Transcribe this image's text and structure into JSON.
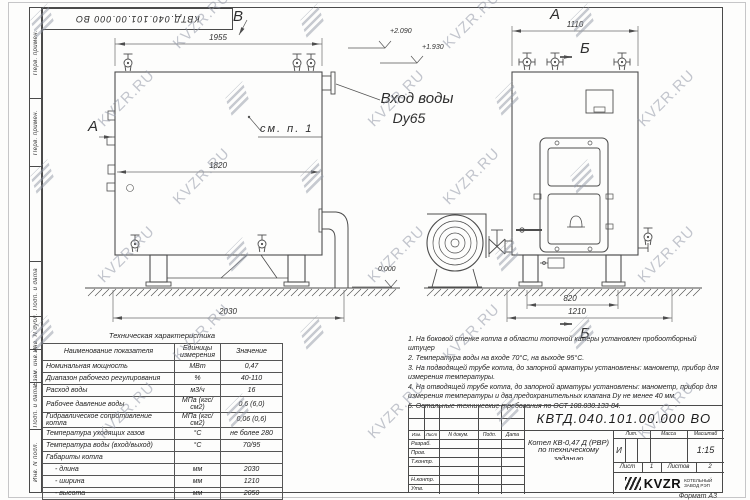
{
  "sheet": {
    "watermark_text": "KVZR.RU",
    "stamp_doc_number": "КВТД.040.101.00.000 ВО",
    "margin_labels": [
      "Перв. примен.",
      "Перв. примен.",
      "Подп. и дата",
      "Инв. N дубл.",
      "Взам. инв. N",
      "Подп. и дата",
      "Инв. N подл."
    ],
    "format_label": "Формат А3"
  },
  "left_view": {
    "dim_top": "1955",
    "dim_inner": "1820",
    "dim_bottom": "2030",
    "label_a": "А",
    "label_b": "В",
    "see_note": "см. п. 1",
    "elev_top": "+2.090",
    "elev_mid": "+1.930",
    "elev_zero": "0.000",
    "inlet_title": "Вход воды",
    "inlet_size": "Dy65"
  },
  "right_view": {
    "dim_top": "1110",
    "dim_base": "820",
    "dim_outer": "1210",
    "label_a": "А",
    "label_b_top": "Б",
    "label_b_bottom": "Б"
  },
  "spec_table": {
    "title": "Техническая характеристика",
    "headers": [
      "Наименование показателя",
      "Единицы измерения",
      "Значение"
    ],
    "rows": [
      [
        "Номинальная мощность",
        "МВт",
        "0,47"
      ],
      [
        "Диапазон рабочего регулирования",
        "%",
        "40-110"
      ],
      [
        "Расход воды",
        "м3/ч",
        "16"
      ],
      [
        "Рабочее давление воды",
        "МПа (кгс/см2)",
        "0,6 (6,0)"
      ],
      [
        "Гидравлическое сопротивление котла",
        "МПа (кгс/см2)",
        "0,06 (0,6)"
      ],
      [
        "Температура уходящих газов",
        "°С",
        "не более 280"
      ],
      [
        "Температура воды (вход/выход)",
        "°С",
        "70/95"
      ],
      [
        "Габариты котла",
        "",
        ""
      ],
      [
        "- длина",
        "мм",
        "2030"
      ],
      [
        "- ширина",
        "мм",
        "1210"
      ],
      [
        "- высота",
        "мм",
        "2050"
      ]
    ]
  },
  "notes": {
    "items": [
      "1. На боковой стенке котла в области топочной камеры установлен пробоотборный штуцер",
      "2. Температура воды на входе 70°С, на выходе 95°С.",
      "3. На подводящей трубе котла, до запорной арматуры установлены: манометр, прибор для измерения температуры.",
      "4. На отводящей трубе котла, до запорной арматуры установлены: манометр, прибор для измерения температуры и два предохранительных клапана Dу не менее 40 мм.",
      "5. Остальные технические требования по ОСТ 108.030.133-84."
    ]
  },
  "title_block": {
    "doc_number": "КВТД.040.101.00.000 ВО",
    "product_line1": "Котел КВ-0,47 Д (РВР)",
    "product_line2": "по техническому заданию",
    "header_cols": [
      "Изм.",
      "Лист",
      "N докум.",
      "Подп.",
      "Дата"
    ],
    "roles": [
      "Разраб.",
      "Пров.",
      "Т.контр.",
      "",
      "Н.контр.",
      "Утв."
    ],
    "lit_label": "Лит.",
    "mass_label": "Масса",
    "scale_label": "Масштаб",
    "lit_value": "И",
    "scale_value": "1:15",
    "sheet_label": "Лист",
    "sheet_value": "1",
    "sheets_label": "Листов",
    "sheets_value": "2",
    "logo_text": "KVZR",
    "logo_caption1": "КОТЕЛЬНЫЙ",
    "logo_caption2": "ЗАВОД РЭП"
  }
}
